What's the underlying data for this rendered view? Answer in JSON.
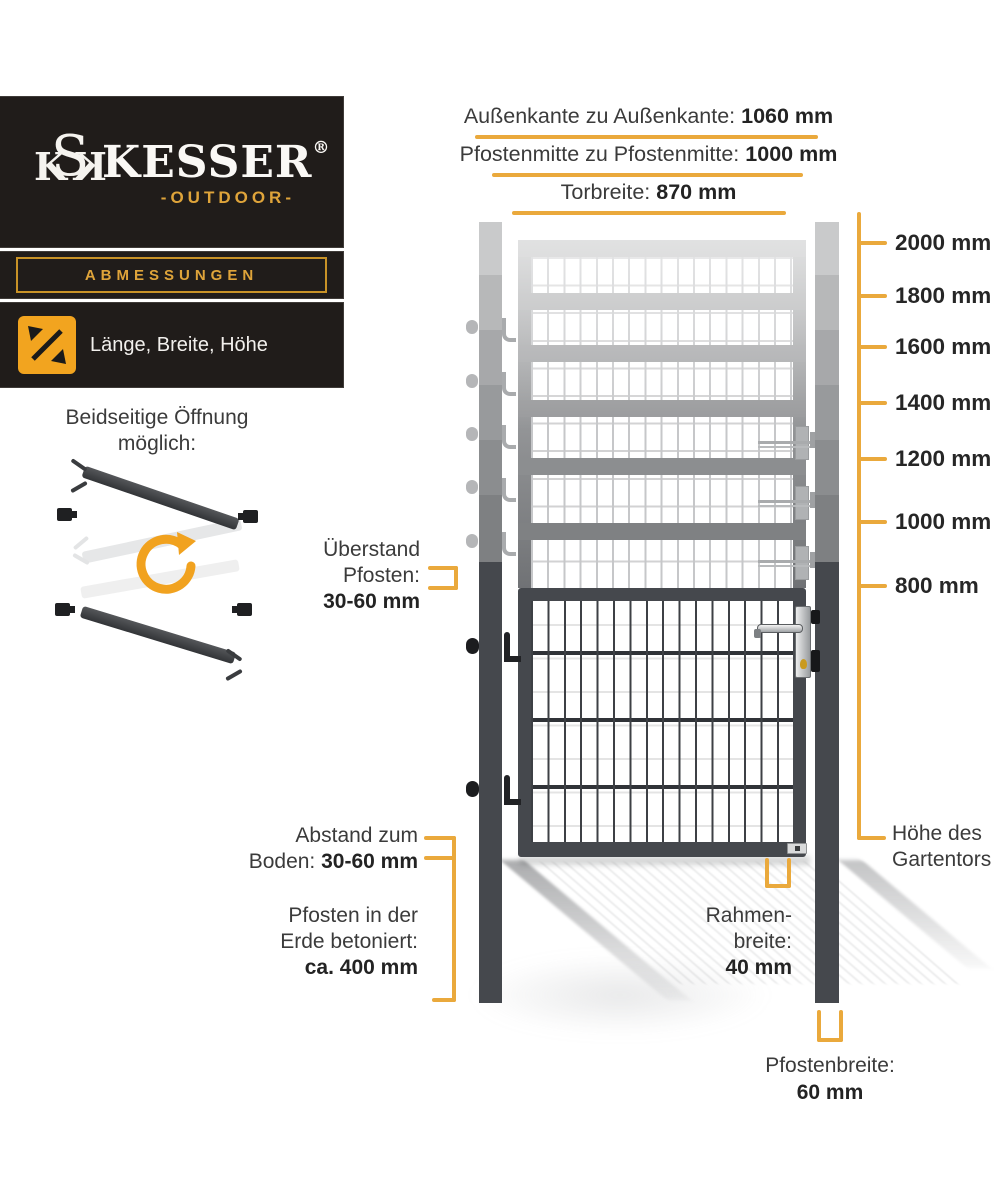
{
  "colors": {
    "accent": "#EAA93C",
    "accent_bright": "#F2A41F",
    "panel_bg": "#201C1A",
    "gold_text": "#DFA43A",
    "frame_dark": "#45484D",
    "label_text": "#3B3B3B"
  },
  "brand": {
    "monogram_left": "K",
    "monogram_s": "S",
    "monogram_right": "K",
    "name": "KESSER",
    "registered": "®",
    "tagline": "-OUTDOOR-"
  },
  "badge": {
    "label": "ABMESSUNGEN"
  },
  "dimension_chip": {
    "label": "Länge, Breite, Höhe",
    "icon": "diagonal-arrows-icon"
  },
  "opening_note": {
    "line1": "Beidseitige Öffnung",
    "line2": "möglich:"
  },
  "top_dimensions": [
    {
      "label": "Außenkante zu Außenkante:",
      "value": "1060 mm"
    },
    {
      "label": "Pfostenmitte zu Pfostenmitte:",
      "value": "1000 mm"
    },
    {
      "label": "Torbreite:",
      "value": "870 mm"
    }
  ],
  "height_scale": {
    "labels": [
      "2000 mm",
      "1800 mm",
      "1600 mm",
      "1400 mm",
      "1200 mm",
      "1000 mm",
      "800 mm"
    ]
  },
  "annotations": {
    "ueberstand": {
      "line1": "Überstand",
      "line2": "Pfosten:",
      "value": "30-60 mm"
    },
    "abstand": {
      "line1": "Abstand zum",
      "line2_label": "Boden:",
      "line2_value": "30-60 mm"
    },
    "pfosten_erde": {
      "line1": "Pfosten in der",
      "line2": "Erde betoniert:",
      "value": "ca. 400 mm"
    },
    "rahmenbreite": {
      "line1": "Rahmen-",
      "line2": "breite:",
      "value": "40 mm"
    },
    "hoehe": {
      "line1": "Höhe des",
      "line2": "Gartentors"
    },
    "pfostenbreite": {
      "label": "Pfostenbreite:",
      "value": "60 mm"
    }
  }
}
